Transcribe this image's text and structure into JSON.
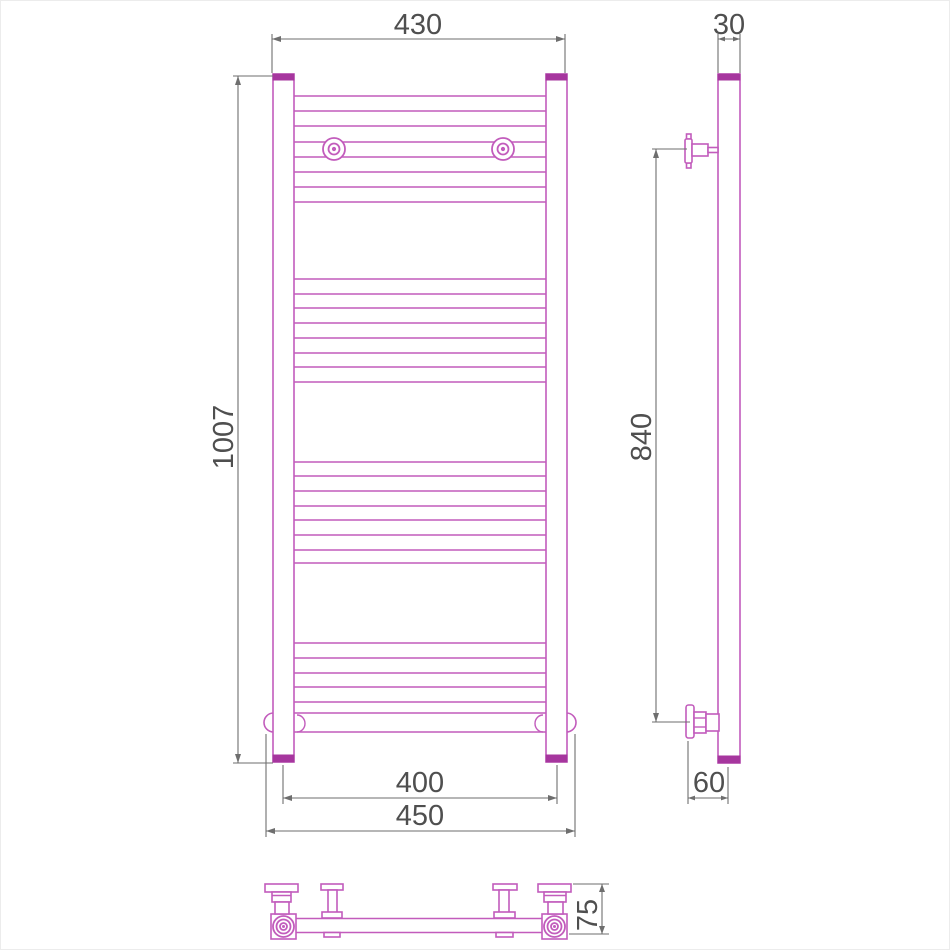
{
  "colors": {
    "outline": "#c25cbc",
    "outlineDark": "#a6369e",
    "dim": "#6e6e6e",
    "label": "#4f4f4f",
    "bg": "#ffffff",
    "frame": "#ececec"
  },
  "dimensions": {
    "top_width_mm": "430",
    "side_depth_mm": "30",
    "overall_height_mm": "1007",
    "mount_height_mm": "840",
    "axes_width_mm": "400",
    "overall_width_mm": "450",
    "wall_offset_mm": "60",
    "bottom_depth_mm": "75"
  }
}
